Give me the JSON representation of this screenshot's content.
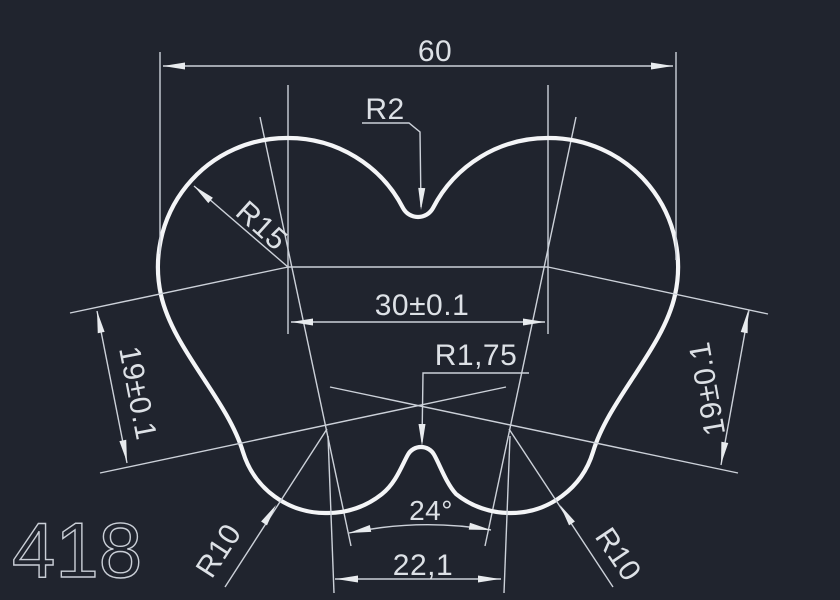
{
  "drawing": {
    "sheet_number": "418",
    "labels": {
      "overall_width": "60",
      "top_fillet_radius": "R2",
      "lobe_radius": "R15",
      "center_distance": "30±0.1",
      "bottom_notch_radius": "R1,75",
      "side_left": "19±0.1",
      "side_right": "19±0.1",
      "bottom_angle": "24°",
      "bottom_distance": "22,1",
      "bottom_left_radius": "R10",
      "bottom_right_radius": "R10"
    },
    "colors": {
      "background": "#20242e",
      "outline": "#f4f5f7",
      "dimension_lines": "#ccd1d9",
      "dimension_text": "#dde1e6"
    }
  }
}
